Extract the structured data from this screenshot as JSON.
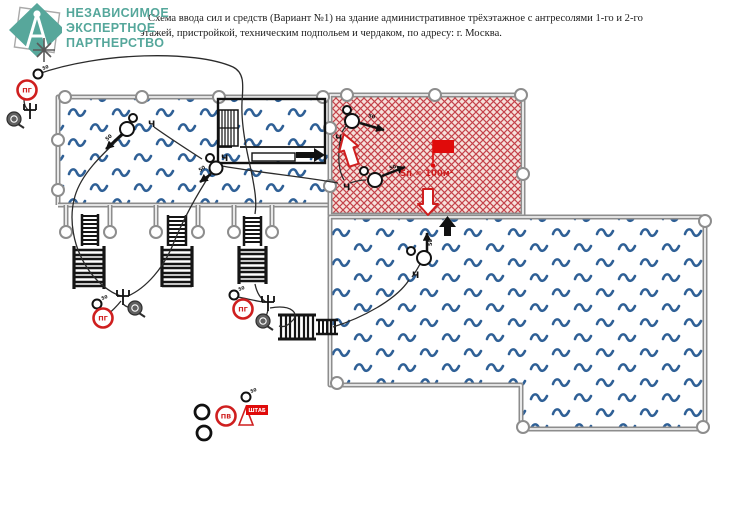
{
  "header": {
    "logo": {
      "line1": "НЕЗАВИСИМОЕ",
      "line2": "ЭКСПЕРТНОЕ",
      "line3": "ПАРТНЕРСТВО"
    },
    "title_line1": "Схема ввода сил и средств (Вариант №1) на здание административное трёхэтажное с антресолями 1-го и 2-го",
    "title_line2": "этажей, пристройкой, техническим подпольем и чердаком, по адресу: г. Москва."
  },
  "plan": {
    "labels": {
      "hydrant": "ПГ",
      "reservoir": "ПВ",
      "headquarters": "ШТАБ",
      "fire_area": "Sп = 100м²",
      "nozzle_50": "50",
      "branch": "Ч"
    },
    "colors": {
      "accent_red": "#cf1f1f",
      "wave_blue": "#2f6096",
      "wall_gray": "#8d8d8d",
      "logo_teal": "#55a79b"
    }
  }
}
